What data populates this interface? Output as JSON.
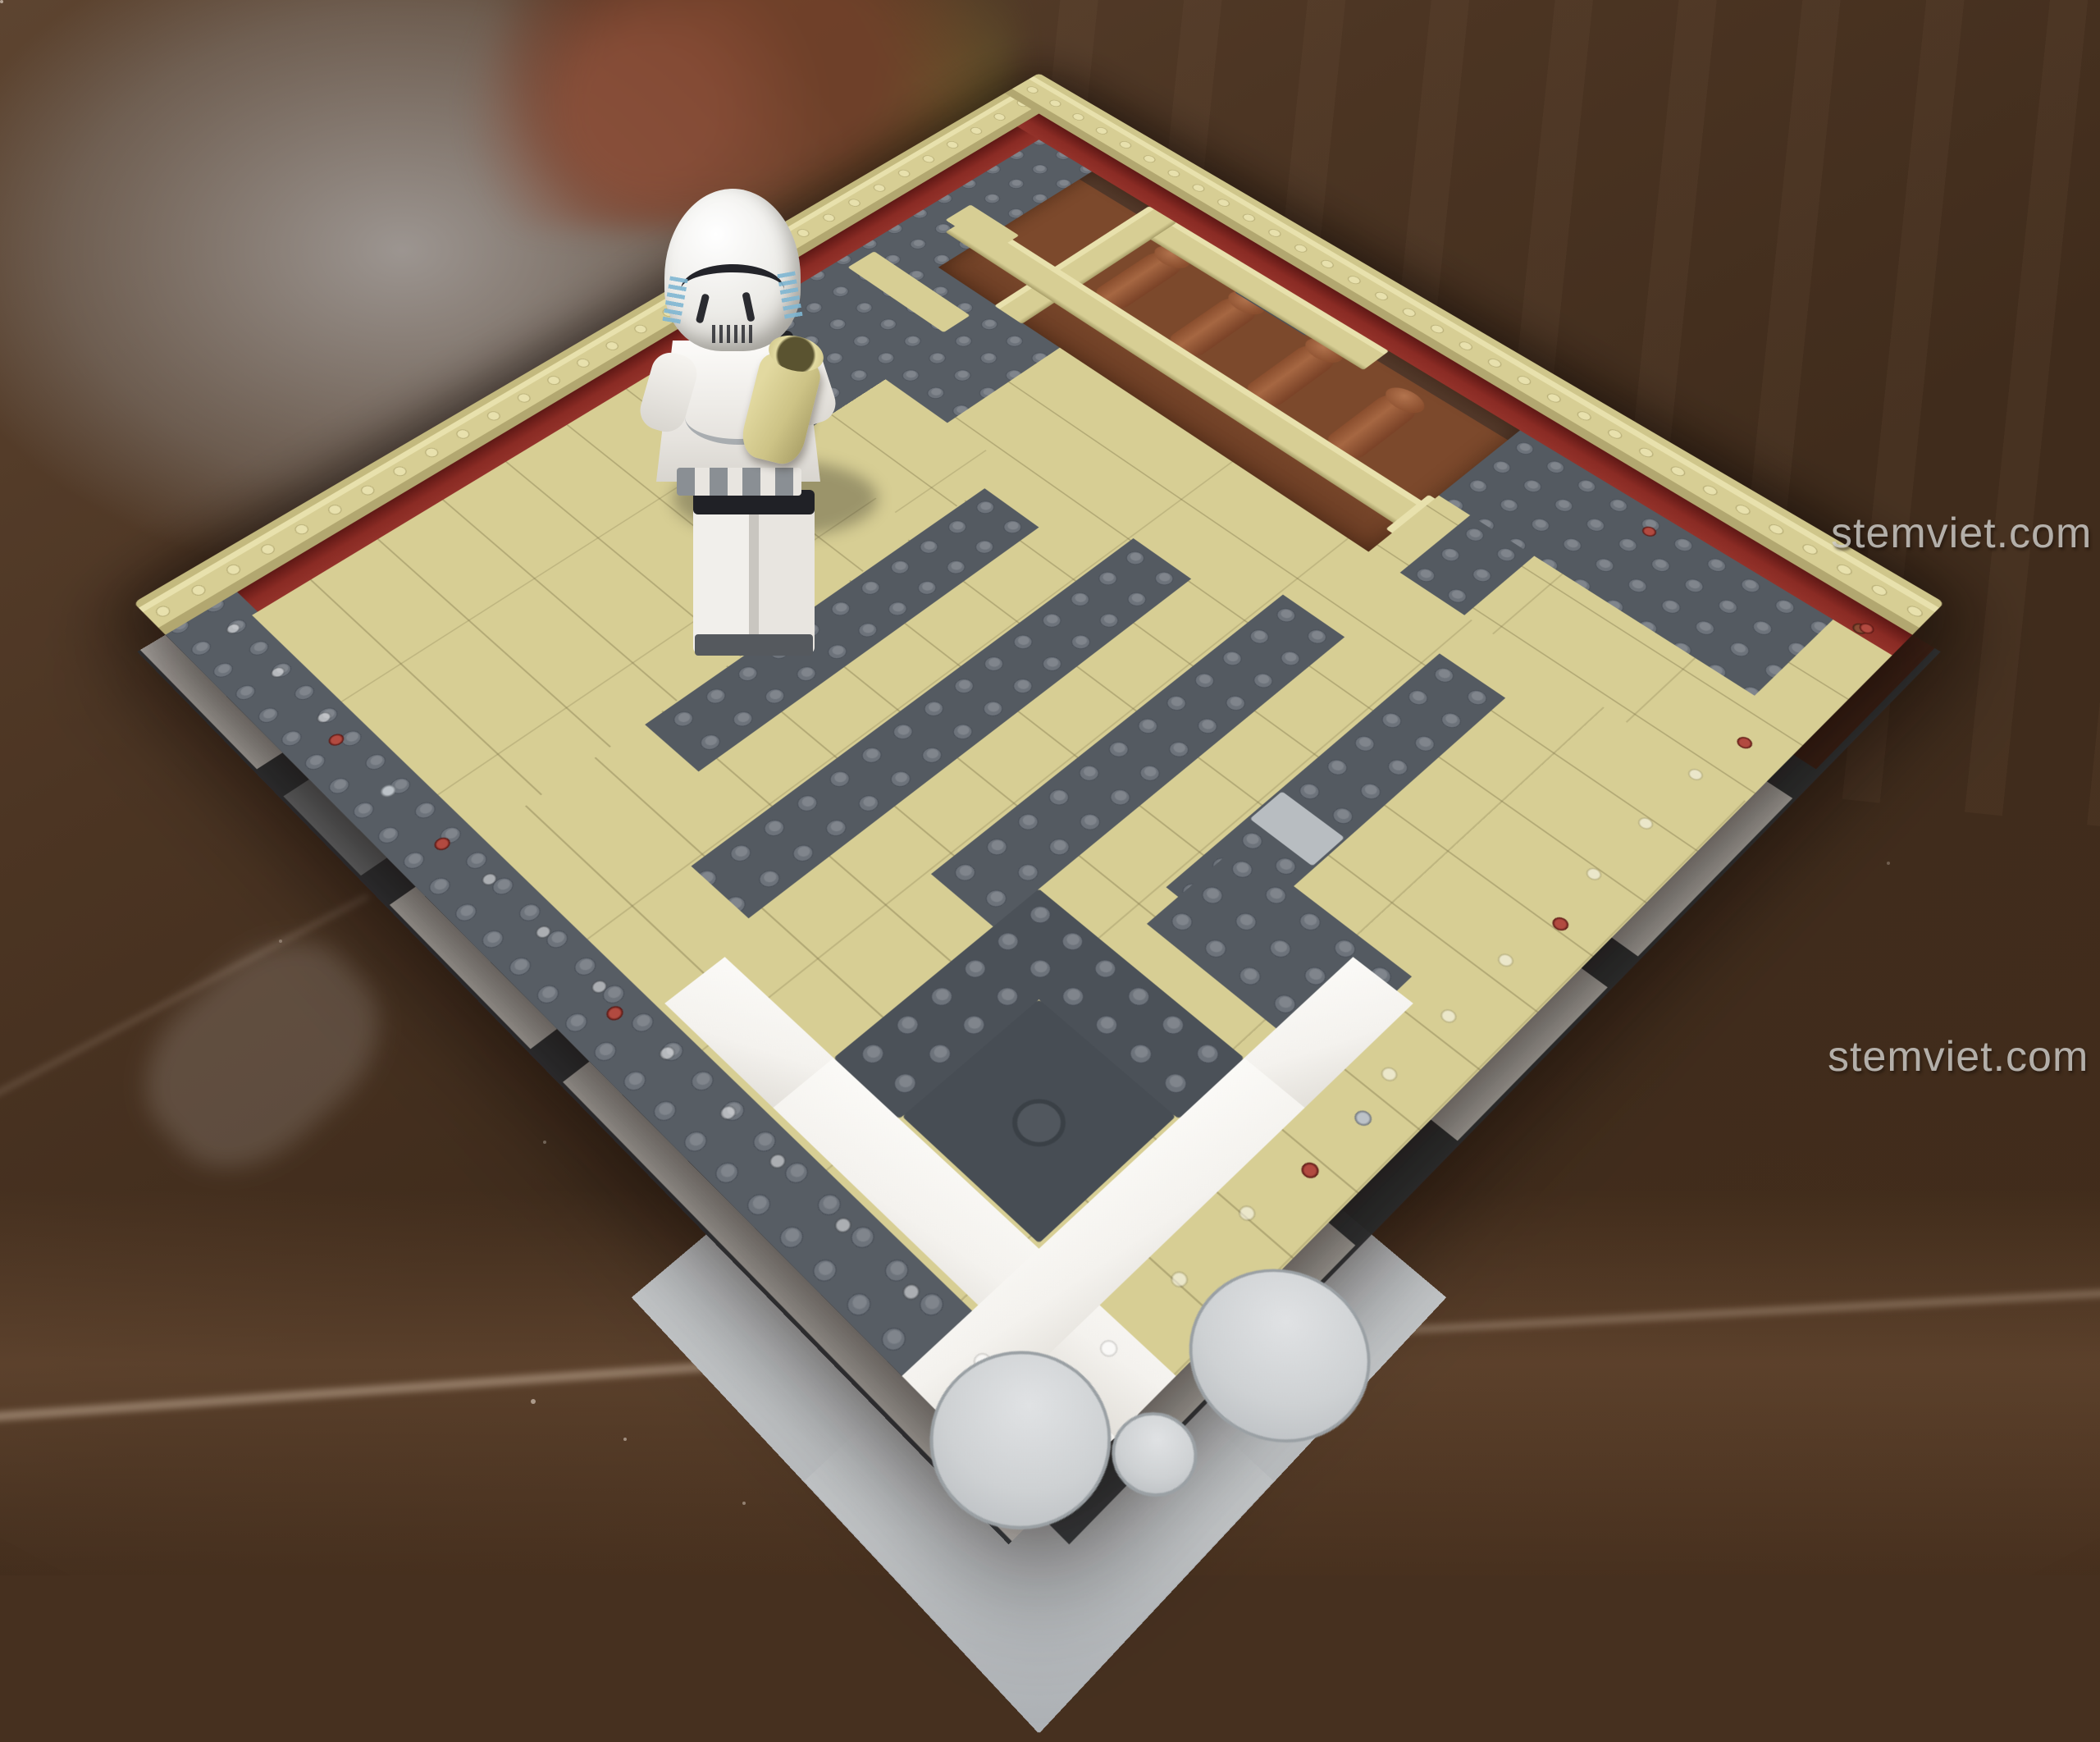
{
  "scene": {
    "subject": "LEGO Star Wars cantina-style interior build in progress, photographed on a glossy dark brown table",
    "figure": "stormtrooper minifigure with black blaster and tan jug accessory"
  },
  "watermarks": [
    {
      "text": "stemviet.com"
    },
    {
      "text": "stemviet.com"
    }
  ],
  "palette": {
    "tan": "#d7ce94",
    "tanL": "#e8e1ad",
    "tanD": "#b5ab76",
    "red": "#8a2b24",
    "gray": "#575d64",
    "grayL": "#6d737b",
    "lgray": "#9ba1a7",
    "landing": "#c5c8ca",
    "rtile": "#ced1d3",
    "white": "#f4f2ee",
    "brown": "#7c492c",
    "rbrown": "#6f3b27",
    "table": "#46301f"
  }
}
